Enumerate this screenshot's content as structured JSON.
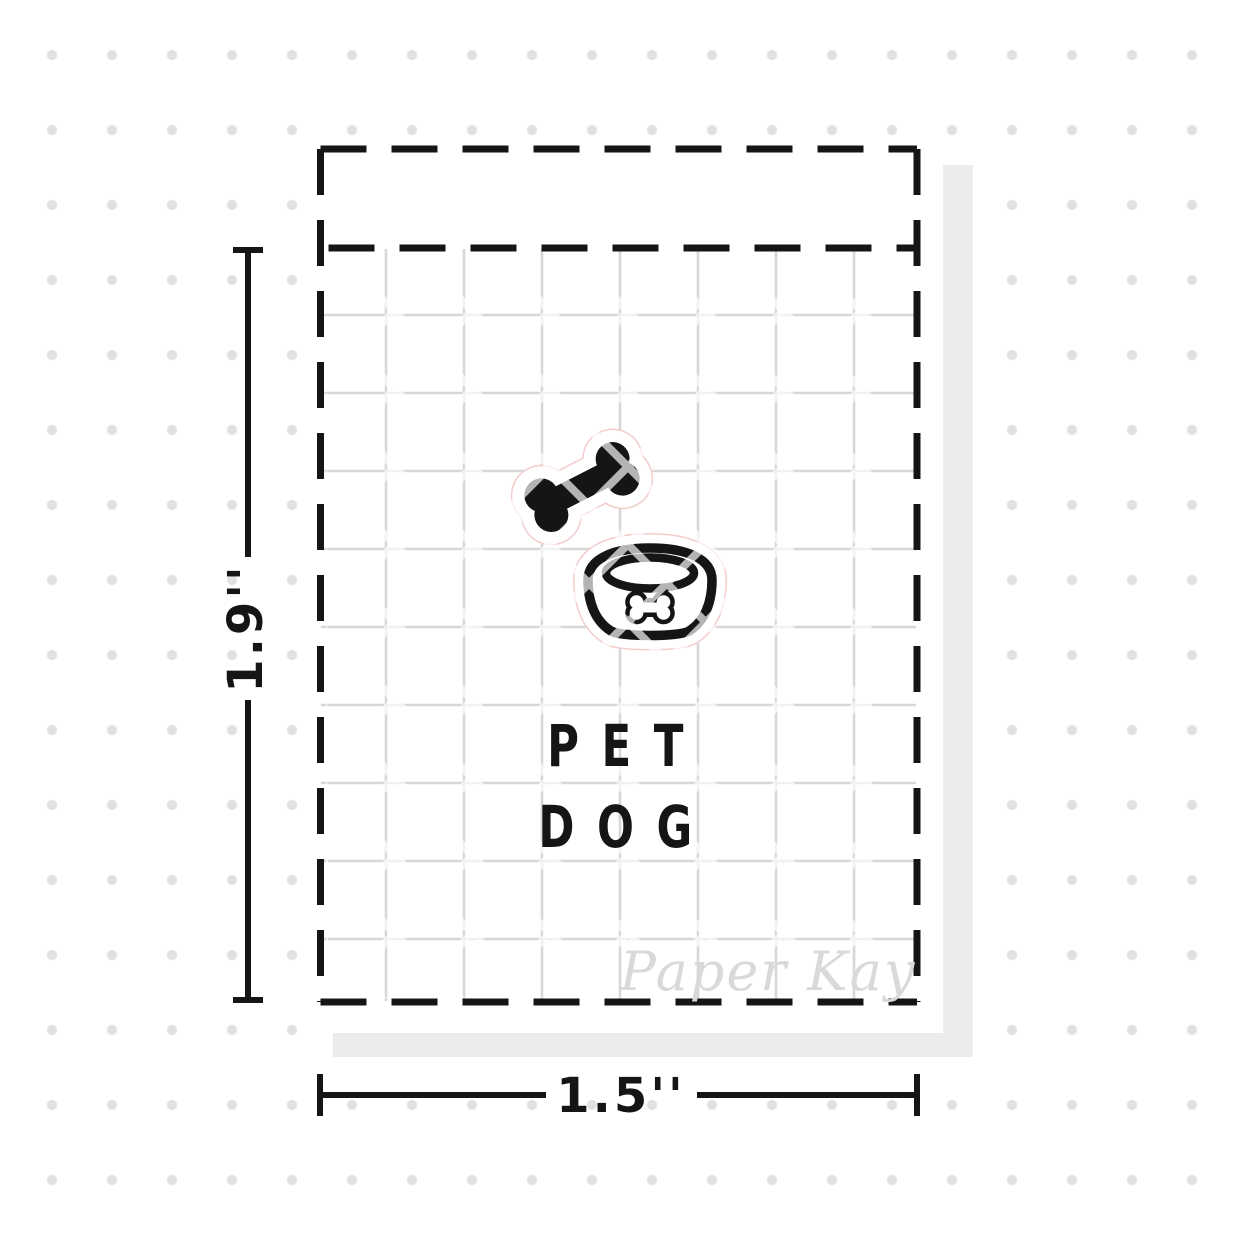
{
  "mockup": {
    "sheet": {
      "title_line1": "PET",
      "title_line2": "DOG",
      "icons": [
        {
          "name": "dog-bone-icon",
          "style": "filled-black"
        },
        {
          "name": "dog-bowl-icon",
          "style": "black-outline-with-bone-emblem"
        }
      ],
      "watermark_text": "Paper Kay"
    },
    "dimension_labels": {
      "height": "1.9''",
      "width": "1.5''"
    }
  },
  "colors": {
    "ink": "#151515",
    "grid": "#d7d7d7",
    "dot": "#e1e1e1",
    "shadow": "#ececec",
    "watermark": "#d9d9d9",
    "cutline": "#f3cccc",
    "stripe_on_black": "#b9b9b9"
  }
}
